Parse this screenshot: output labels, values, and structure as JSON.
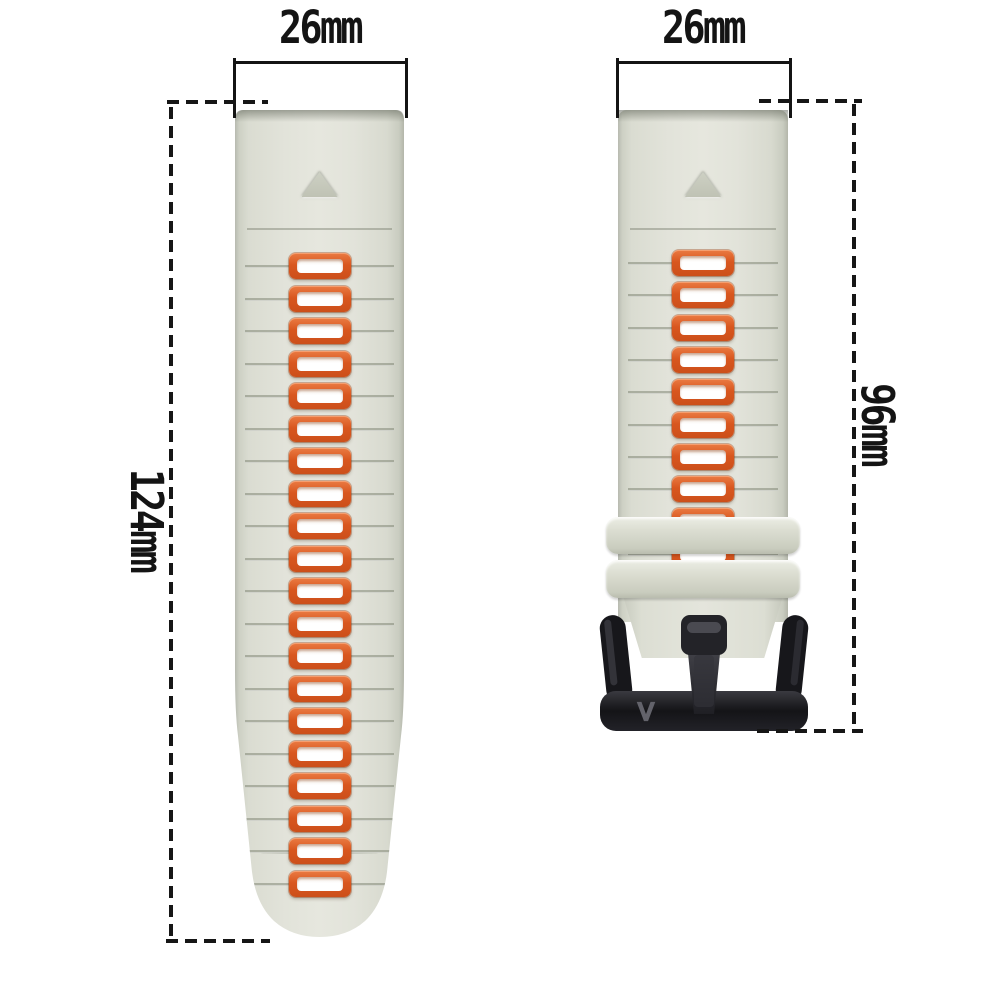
{
  "image_type": "watch-band product photo with size annotations",
  "dimensions": {
    "left_width": "26mm",
    "left_length": "124mm",
    "right_width": "26mm",
    "right_length": "96mm"
  },
  "straps": {
    "left": {
      "hole_count": 20
    },
    "right": {
      "hole_count": 10,
      "keeper_count": 2
    }
  },
  "buckle": {
    "logo": "V"
  },
  "colors": {
    "background": "#ffffff",
    "strap": "#e2e3da",
    "strap_edge": "#b7bab0",
    "hole_ring": "#d9571f",
    "hole_fill": "#ffffff",
    "buckle": "#18181c",
    "dimension_ink": "#141414"
  }
}
